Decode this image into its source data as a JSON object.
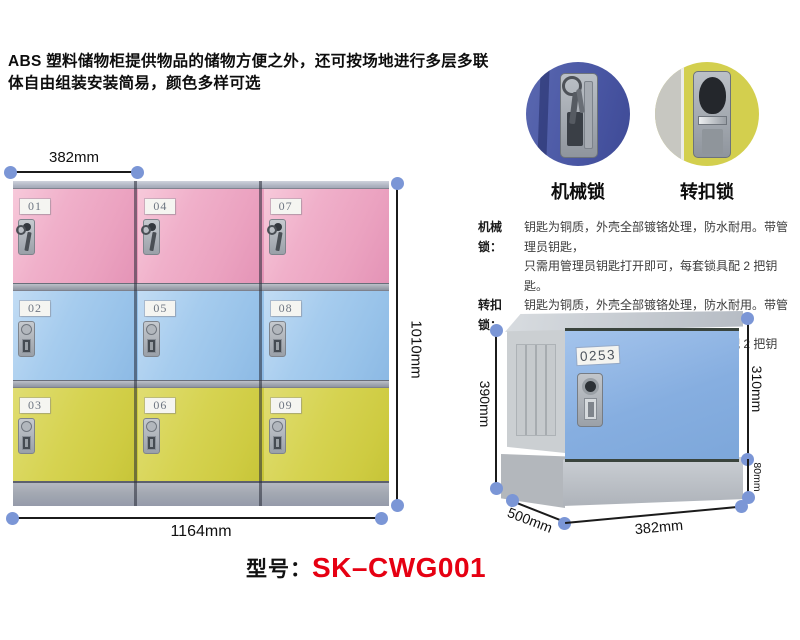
{
  "intro": {
    "line1": "ABS 塑料储物柜提供物品的储物方便之外，还可按场地进行多层多联",
    "line2": "体自由组装安装简易，颜色多样可选"
  },
  "lock_photos": {
    "mechanical_label": "机械锁",
    "turnbuckle_label": "转扣锁"
  },
  "lock_descriptions": [
    {
      "label": "机械锁：",
      "line1": "钥匙为铜质，外壳全部镀铬处理，防水耐用。带管理员钥匙，",
      "line2": "只需用管理员钥匙打开即可，每套锁具配 2 把钥匙。"
    },
    {
      "label": "转扣锁：",
      "line1": "钥匙为铜质，外壳全部镀铬处理，防水耐用。带管理员钥匙，",
      "line2": "只需用管理员钥匙打开即可，每套锁具配 2 把钥匙。"
    }
  ],
  "main_locker": {
    "door_rows": [
      {
        "color": "pink",
        "numbers": [
          "01",
          "04",
          "07"
        ]
      },
      {
        "color": "blue",
        "numbers": [
          "02",
          "05",
          "08"
        ]
      },
      {
        "color": "yellow",
        "numbers": [
          "03",
          "06",
          "09"
        ]
      }
    ],
    "dim_top": "382mm",
    "dim_right": "1010mm",
    "dim_bottom": "1164mm"
  },
  "single_locker": {
    "door_number": "0253",
    "dim_left": "390mm",
    "dim_door_height": "310mm",
    "dim_base_height": "80mm",
    "dim_depth": "500mm",
    "dim_width": "382mm"
  },
  "model": {
    "label": "型号：",
    "value": "SK–CWG001"
  },
  "colors": {
    "accent_red": "#e60012",
    "dim_dot_blue": "#7b96d6",
    "door_pink": "#eda6c2",
    "door_blue": "#9cc6ea",
    "door_yellow": "#d4d148",
    "single_door_blue": "#85aedd",
    "frame_gray": "#a6abb5",
    "lock_photo_blue": "#4a56a2",
    "lock_photo_yellow": "#d3cf4e"
  }
}
